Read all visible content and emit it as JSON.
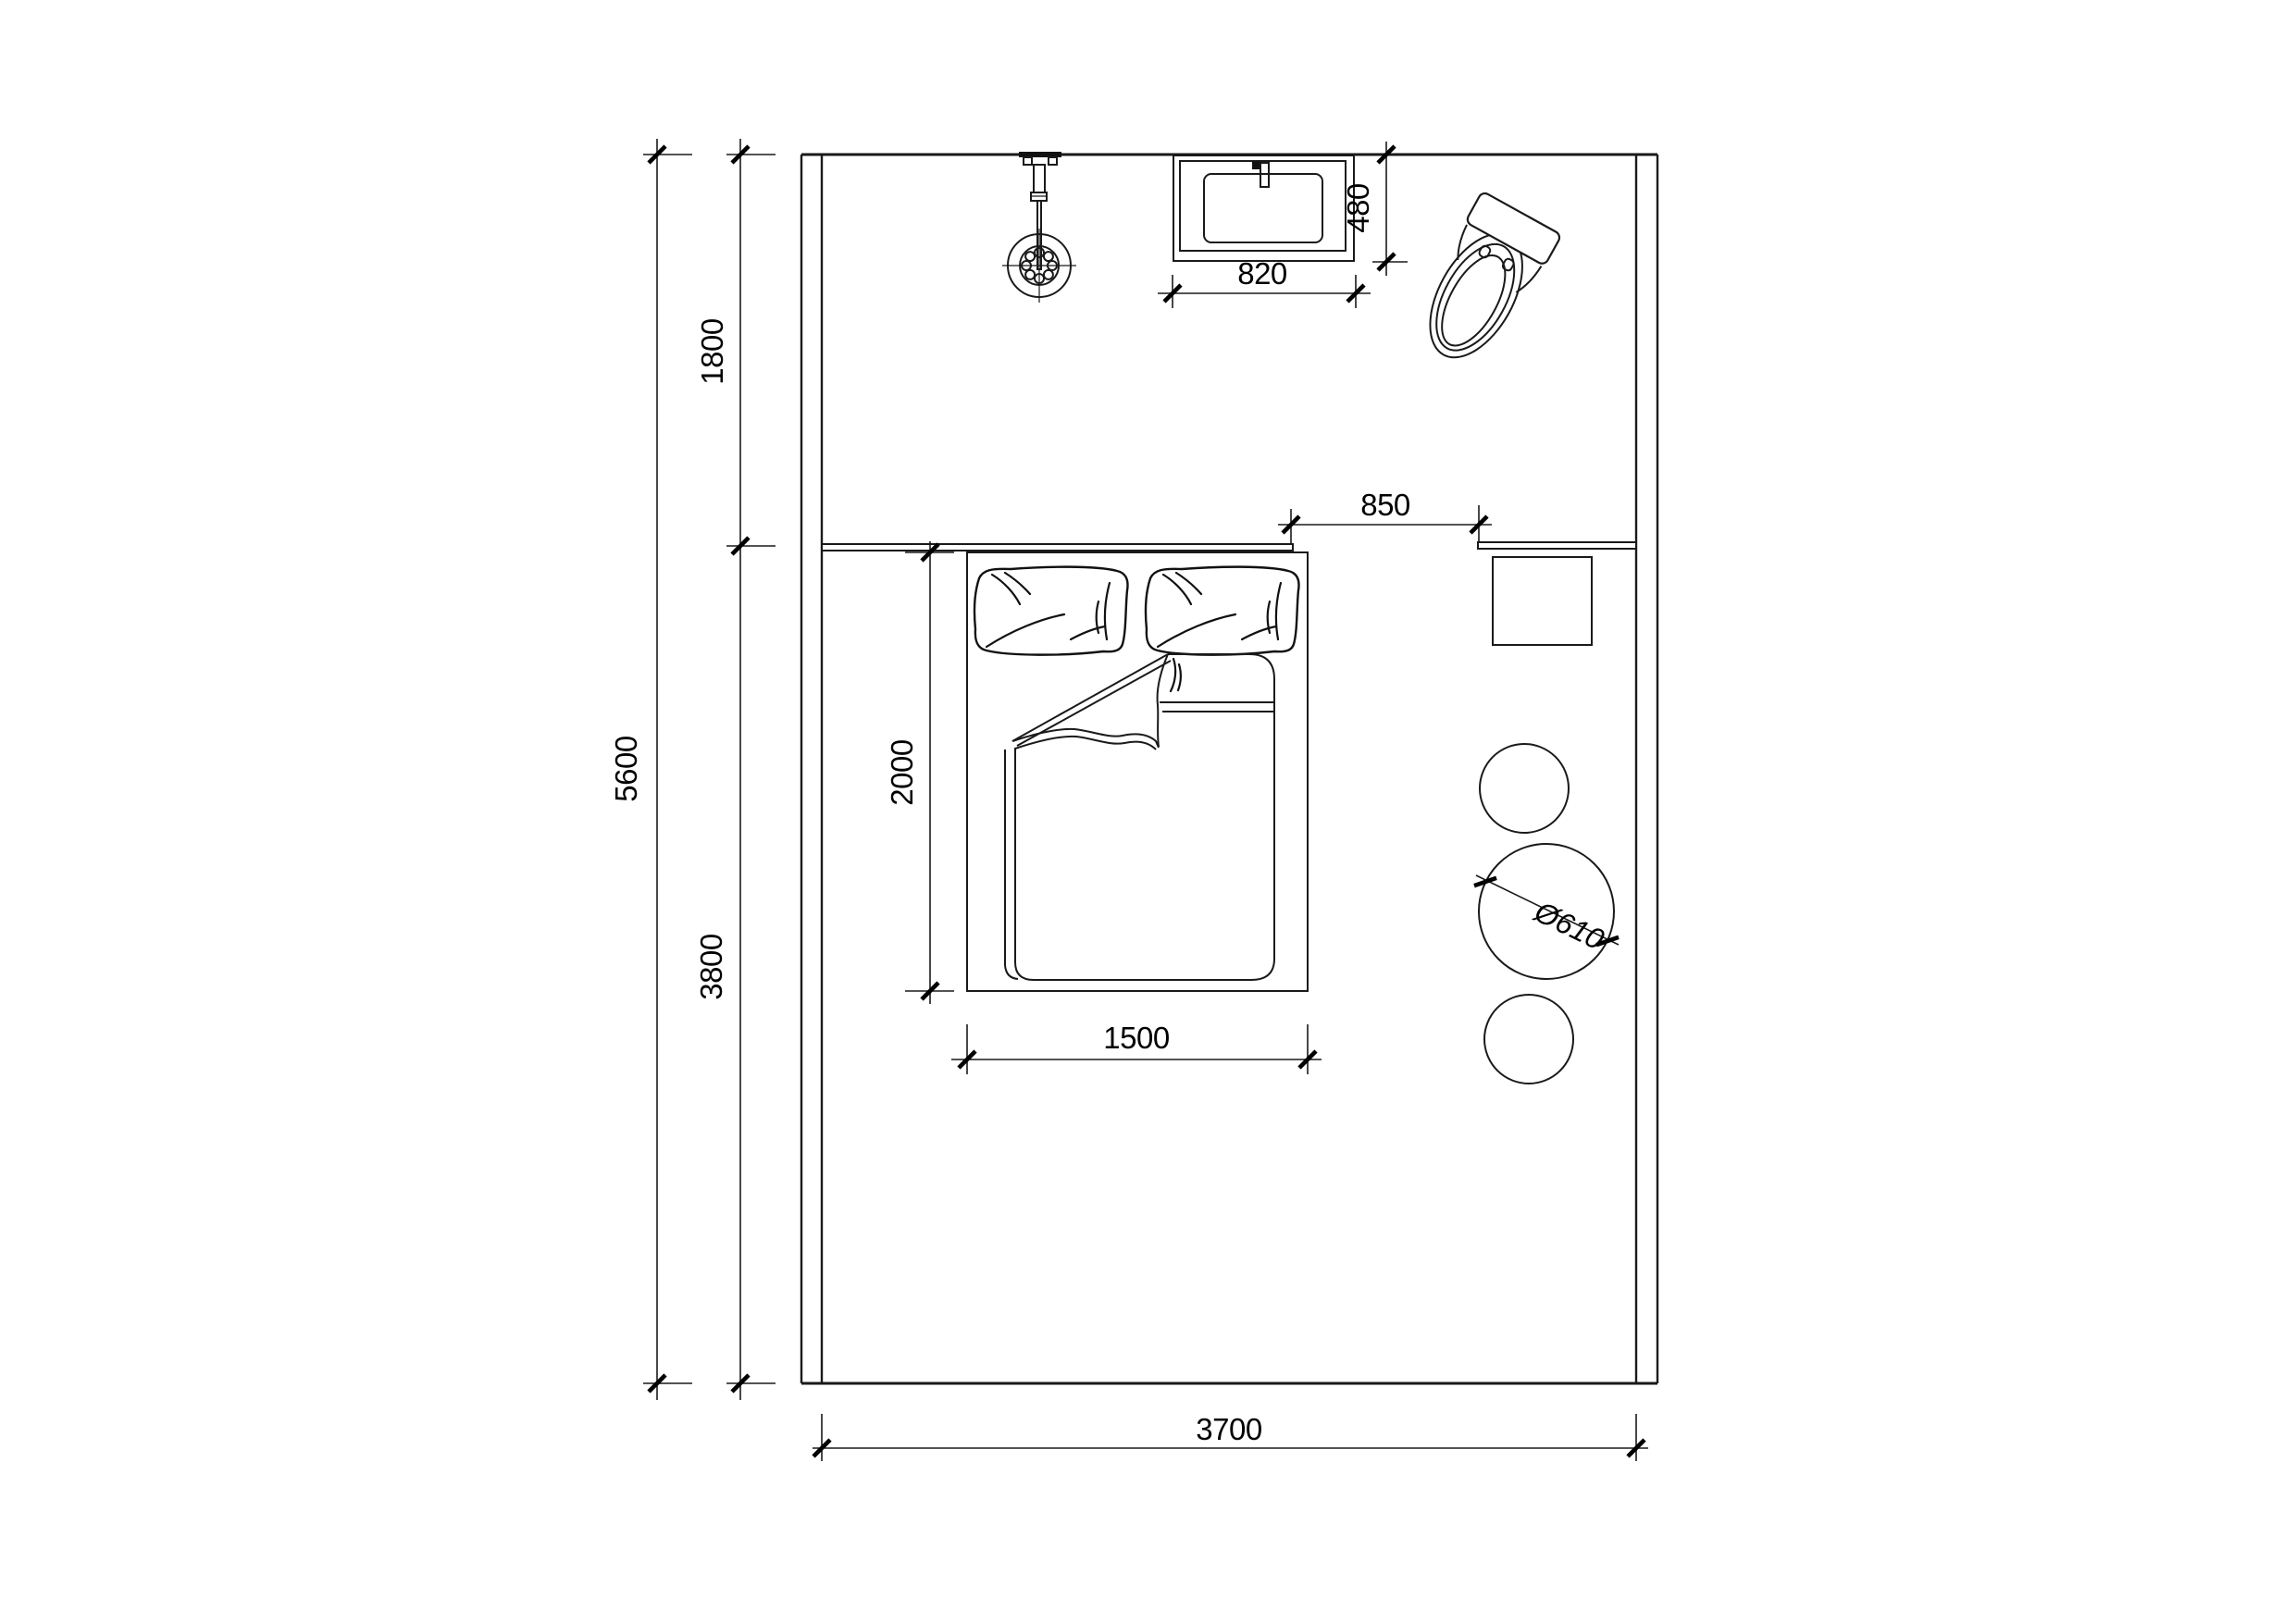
{
  "drawing_labels": {
    "zone_top_depth": "1800",
    "room_depth": "5600",
    "zone_bottom_depth": "3800",
    "bed_length": "2000",
    "bed_width": "1500",
    "vanity_width": "820",
    "vanity_depth": "480",
    "opening_width": "850",
    "round_table_diameter": "Ø610",
    "room_width": "3700"
  },
  "colors": {
    "line": "#1a1a1a",
    "background": "#ffffff"
  }
}
